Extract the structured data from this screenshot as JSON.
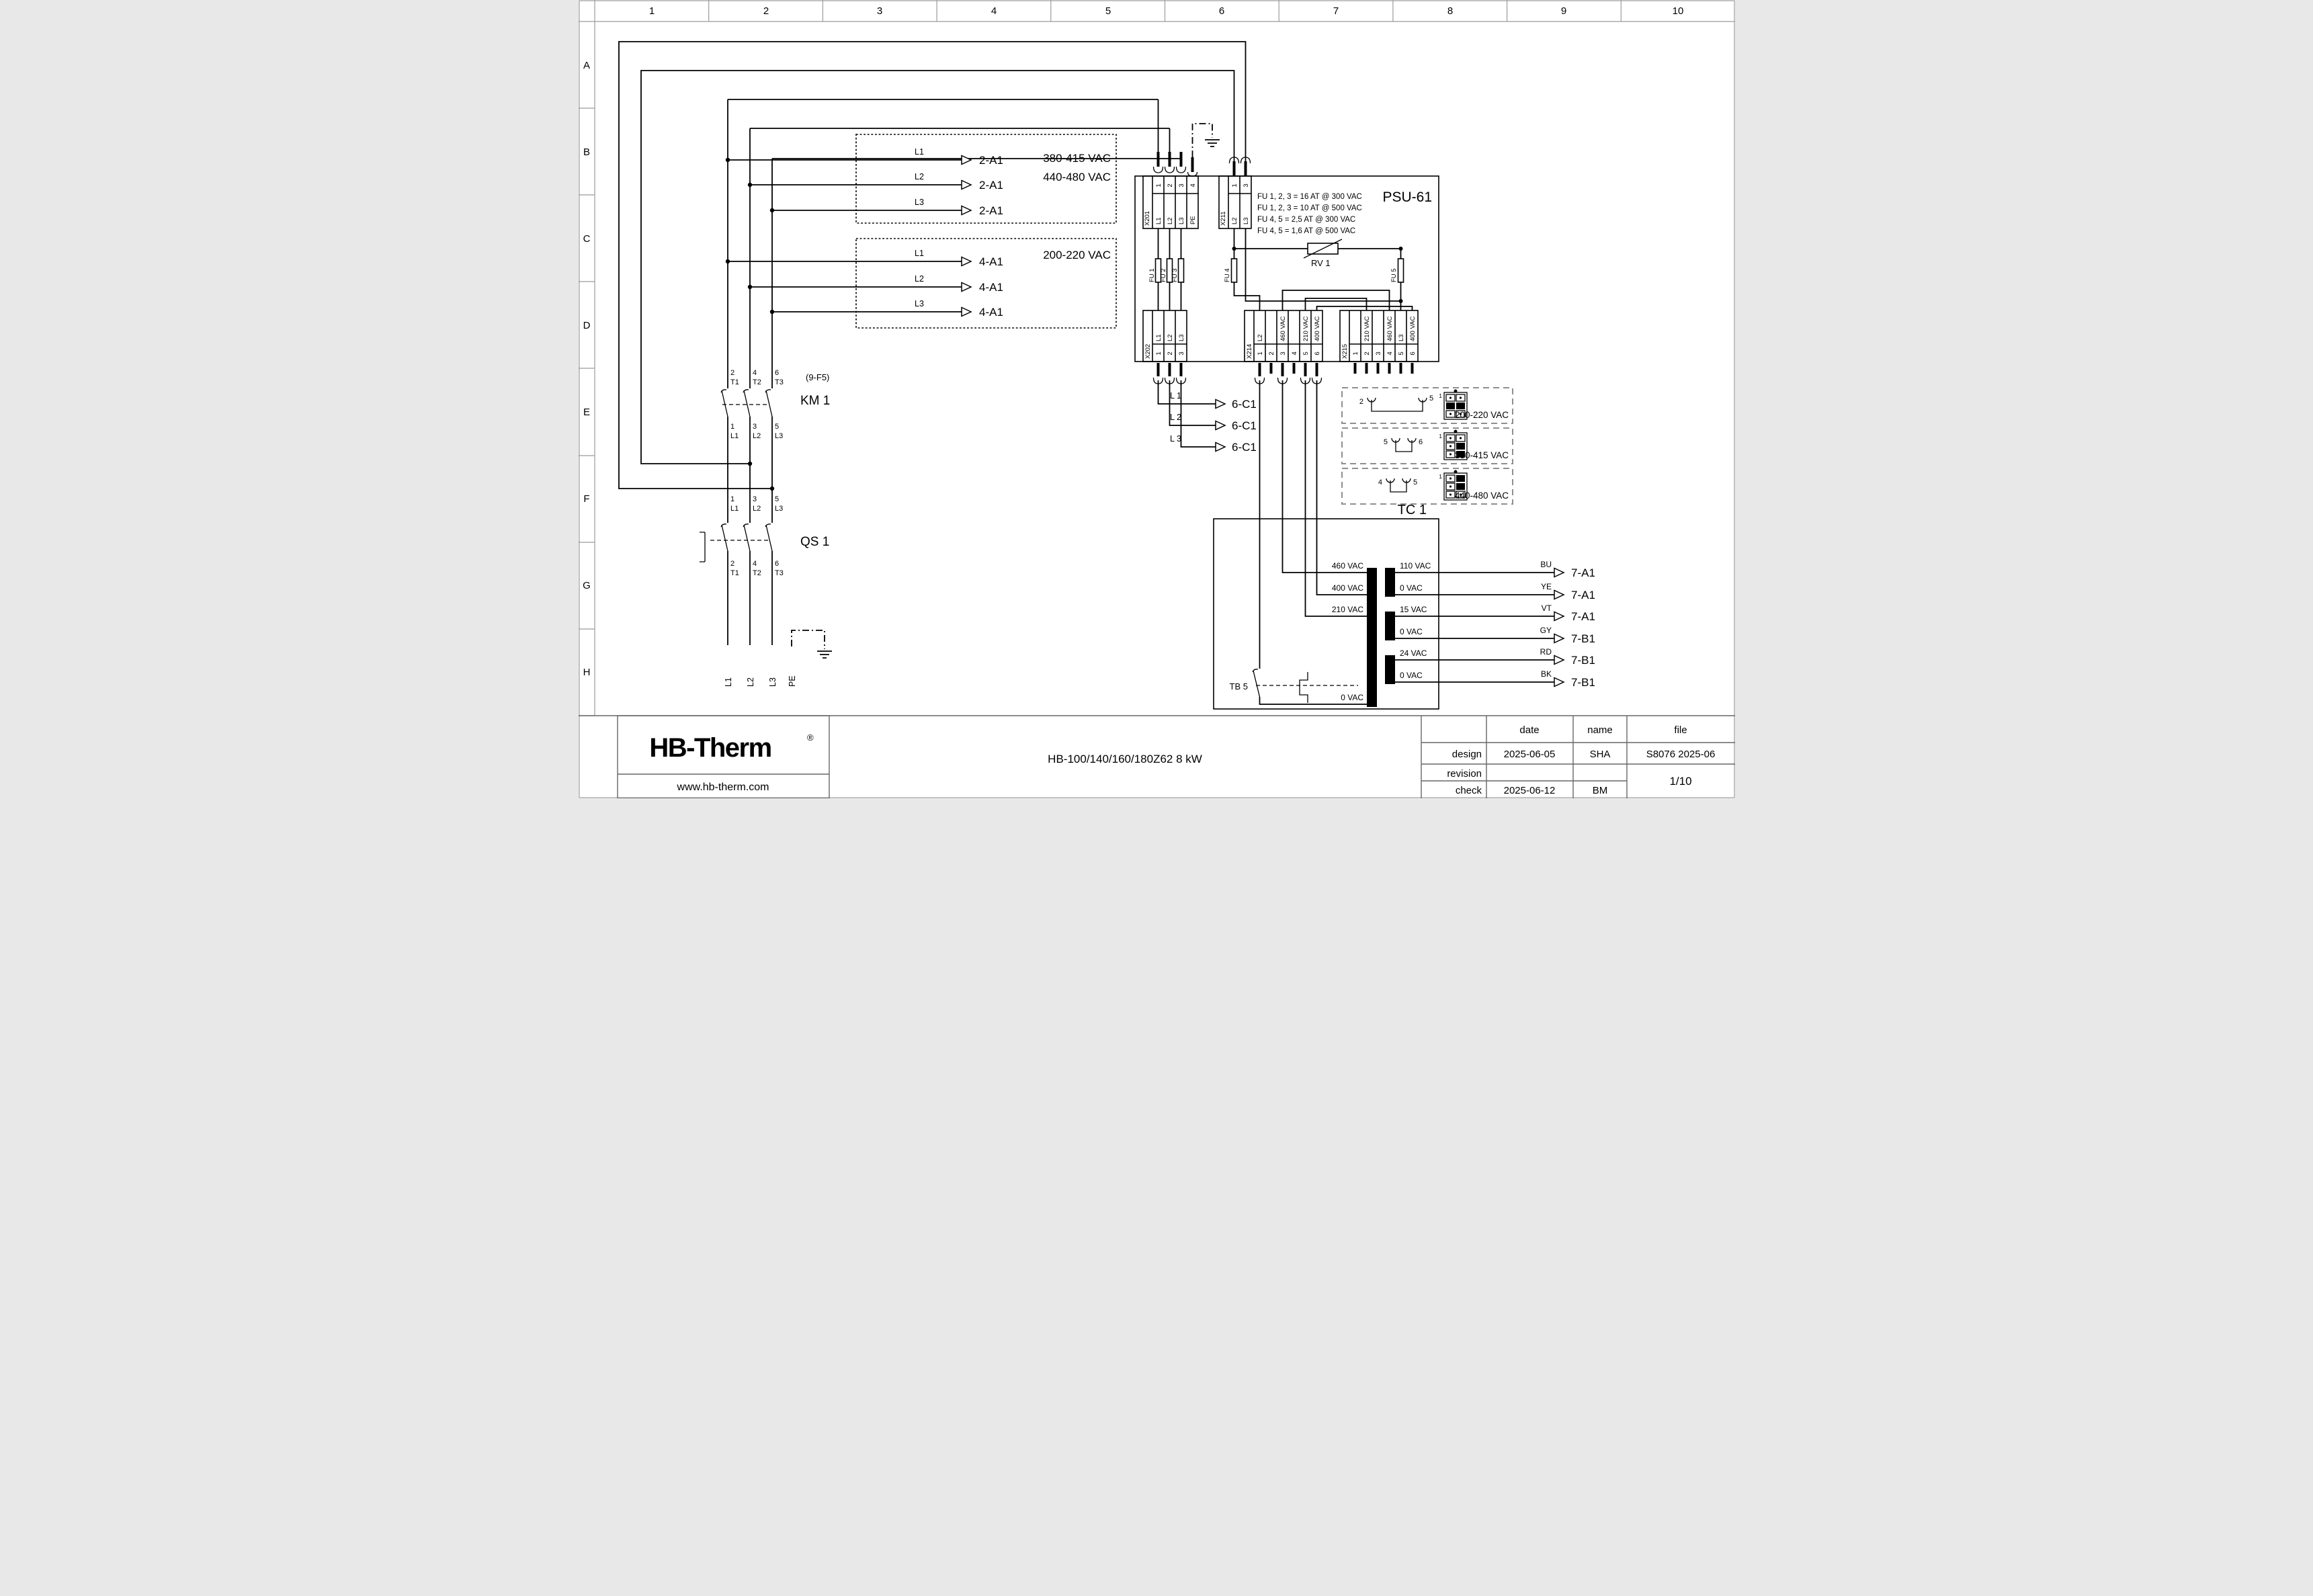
{
  "grid": {
    "columns": [
      "1",
      "2",
      "3",
      "4",
      "5",
      "6",
      "7",
      "8",
      "9",
      "10"
    ],
    "rows": [
      "A",
      "B",
      "C",
      "D",
      "E",
      "F",
      "G",
      "H"
    ]
  },
  "supply": {
    "l1": "L1",
    "l2": "L2",
    "l3": "L3",
    "pe": "PE"
  },
  "qs1": {
    "label": "QS 1",
    "top": [
      {
        "pin": "1",
        "t": "L1"
      },
      {
        "pin": "3",
        "t": "L2"
      },
      {
        "pin": "5",
        "t": "L3"
      }
    ],
    "bottom": [
      {
        "pin": "2",
        "t": "T1"
      },
      {
        "pin": "4",
        "t": "T2"
      },
      {
        "pin": "6",
        "t": "T3"
      }
    ]
  },
  "km1": {
    "label": "KM 1",
    "ref": "(9-F5)",
    "top": [
      {
        "pin": "2",
        "t": "T1"
      },
      {
        "pin": "4",
        "t": "T2"
      },
      {
        "pin": "6",
        "t": "T3"
      }
    ],
    "bottom": [
      {
        "pin": "1",
        "t": "L1"
      },
      {
        "pin": "3",
        "t": "L2"
      },
      {
        "pin": "5",
        "t": "L3"
      }
    ]
  },
  "ref_box_2a1": {
    "voltage1": "380-415 VAC",
    "voltage2": "440-480 VAC",
    "rows": [
      {
        "line": "L1",
        "target": "2-A1"
      },
      {
        "line": "L2",
        "target": "2-A1"
      },
      {
        "line": "L3",
        "target": "2-A1"
      }
    ]
  },
  "ref_box_4a1": {
    "voltage": "200-220 VAC",
    "rows": [
      {
        "line": "L1",
        "target": "4-A1"
      },
      {
        "line": "L2",
        "target": "4-A1"
      },
      {
        "line": "L3",
        "target": "4-A1"
      }
    ]
  },
  "psu": {
    "title": "PSU-61",
    "notes": [
      "FU 1, 2, 3 = 16 AT @ 300 VAC",
      "FU 1, 2, 3 = 10 AT @ 500 VAC",
      "FU 4, 5 = 2,5 AT @ 300 VAC",
      "FU 4, 5 = 1,6 AT @ 500 VAC"
    ],
    "rv1": "RV 1",
    "fu": [
      "FU 1",
      "FU 2",
      "FU 3",
      "FU 4",
      "FU 5"
    ],
    "x201": {
      "name": "X201",
      "pins": [
        "1",
        "2",
        "3",
        "4"
      ],
      "labels": [
        "L1",
        "L2",
        "L3",
        "PE"
      ]
    },
    "x211": {
      "name": "X211",
      "pins": [
        "1",
        "3"
      ],
      "labels": [
        "L2",
        "L3"
      ]
    },
    "x202": {
      "name": "X202",
      "pins": [
        "1",
        "2",
        "3"
      ],
      "labels": [
        "L1",
        "L2",
        "L3"
      ]
    },
    "x214": {
      "name": "X214",
      "pins": [
        "1",
        "2",
        "3",
        "4",
        "5",
        "6"
      ],
      "labels": [
        "L2",
        "",
        "460 VAC",
        "",
        "210 VAC",
        "400 VAC"
      ]
    },
    "x215": {
      "name": "X215",
      "pins": [
        "1",
        "2",
        "3",
        "4",
        "5",
        "6"
      ],
      "labels": [
        "",
        "210 VAC",
        "",
        "460 VAC",
        "L3",
        "400 VAC"
      ]
    }
  },
  "to_6c1": {
    "rows": [
      {
        "line": "L 1",
        "target": "6-C1"
      },
      {
        "line": "L 2",
        "target": "6-C1"
      },
      {
        "line": "L 3",
        "target": "6-C1"
      }
    ]
  },
  "jumpers": [
    {
      "left_pin": "2",
      "right_pin": "5",
      "pin1": "1",
      "voltage": "200-220 VAC"
    },
    {
      "left_pin": "5",
      "right_pin": "6",
      "pin1": "1",
      "voltage": "380-415 VAC"
    },
    {
      "left_pin": "4",
      "right_pin": "5",
      "pin1": "1",
      "voltage": "440-480 VAC"
    }
  ],
  "tc1": {
    "label": "TC 1",
    "tb5": "TB 5",
    "primary_taps": [
      "460 VAC",
      "400 VAC",
      "210 VAC",
      "0 VAC"
    ],
    "secondary_taps": [
      "110 VAC",
      "0 VAC",
      "15 VAC",
      "0 VAC",
      "24 VAC",
      "0 VAC"
    ]
  },
  "outputs": {
    "rows": [
      {
        "wire": "BU",
        "target": "7-A1"
      },
      {
        "wire": "YE",
        "target": "7-A1"
      },
      {
        "wire": "VT",
        "target": "7-A1"
      },
      {
        "wire": "GY",
        "target": "7-B1"
      },
      {
        "wire": "RD",
        "target": "7-B1"
      },
      {
        "wire": "BK",
        "target": "7-B1"
      }
    ]
  },
  "title_block": {
    "logo": "HB-Therm",
    "logo_reg": "®",
    "website": "www.hb-therm.com",
    "doc_title": "HB-100/140/160/180Z62 8 kW",
    "col_date": "date",
    "col_name": "name",
    "col_file": "file",
    "row_design": "design",
    "design_date": "2025-06-05",
    "design_name": "SHA",
    "row_revision": "revision",
    "row_check": "check",
    "check_date": "2025-06-12",
    "check_name": "BM",
    "file_value": "S8076 2025-06",
    "page": "1/10"
  },
  "colors": {
    "line": "#000000",
    "logo": "#16254c",
    "ruler": "#9b9b9b"
  }
}
